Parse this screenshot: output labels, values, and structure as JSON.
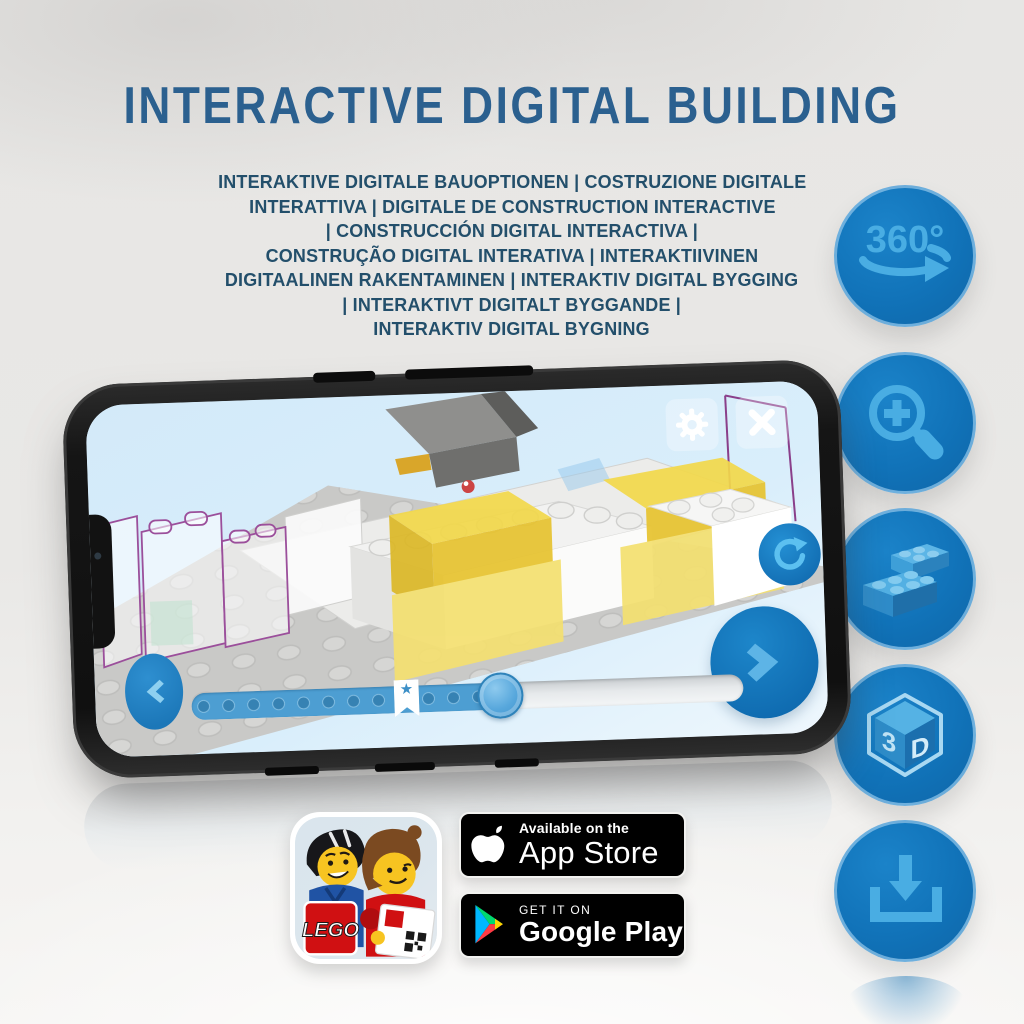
{
  "title": "INTERACTIVE DIGITAL BUILDING",
  "subtitle": {
    "lines": [
      "INTERAKTIVE DIGITALE BAUOPTIONEN | COSTRUZIONE DIGITALE",
      "INTERATTIVA | DIGITALE DE CONSTRUCTION INTERACTIVE",
      "| CONSTRUCCIÓN DIGITAL INTERACTIVA |",
      "CONSTRUÇÃO DIGITAL INTERATIVA | INTERAKTIIVINEN",
      "DIGITAALINEN RAKENTAMINEN | INTERAKTIV DIGITAL BYGGING",
      "| INTERAKTIVT DIGITALT BYGGANDE |",
      "INTERAKTIV DIGITAL BYGNING"
    ]
  },
  "features": [
    {
      "id": "360-view",
      "label": "360°"
    },
    {
      "id": "zoom-in"
    },
    {
      "id": "brick-building"
    },
    {
      "id": "3d-view",
      "left": "3",
      "right": "D"
    },
    {
      "id": "download"
    }
  ],
  "phone": {
    "screen": {
      "slider": {
        "progress_percent": 56,
        "bookmark_percent": 39,
        "knob_percent": 56,
        "bookmark_star": "★"
      }
    }
  },
  "store": {
    "app_icon": {
      "logo_text": "LEGO"
    },
    "app_store_badge": {
      "tagline": "Available on the",
      "name": "App Store"
    },
    "google_play_badge": {
      "tagline": "GET IT ON",
      "name": "Google Play"
    }
  },
  "colors": {
    "title": "#2b608f",
    "subtitle": "#234f6b",
    "feature_circle": "#1173b9",
    "feature_glyph": "#49ade3",
    "screen_sky": "#d8edfa",
    "brick_yellow": "#f2d84a",
    "slider_fill": "#4d9ed2"
  }
}
